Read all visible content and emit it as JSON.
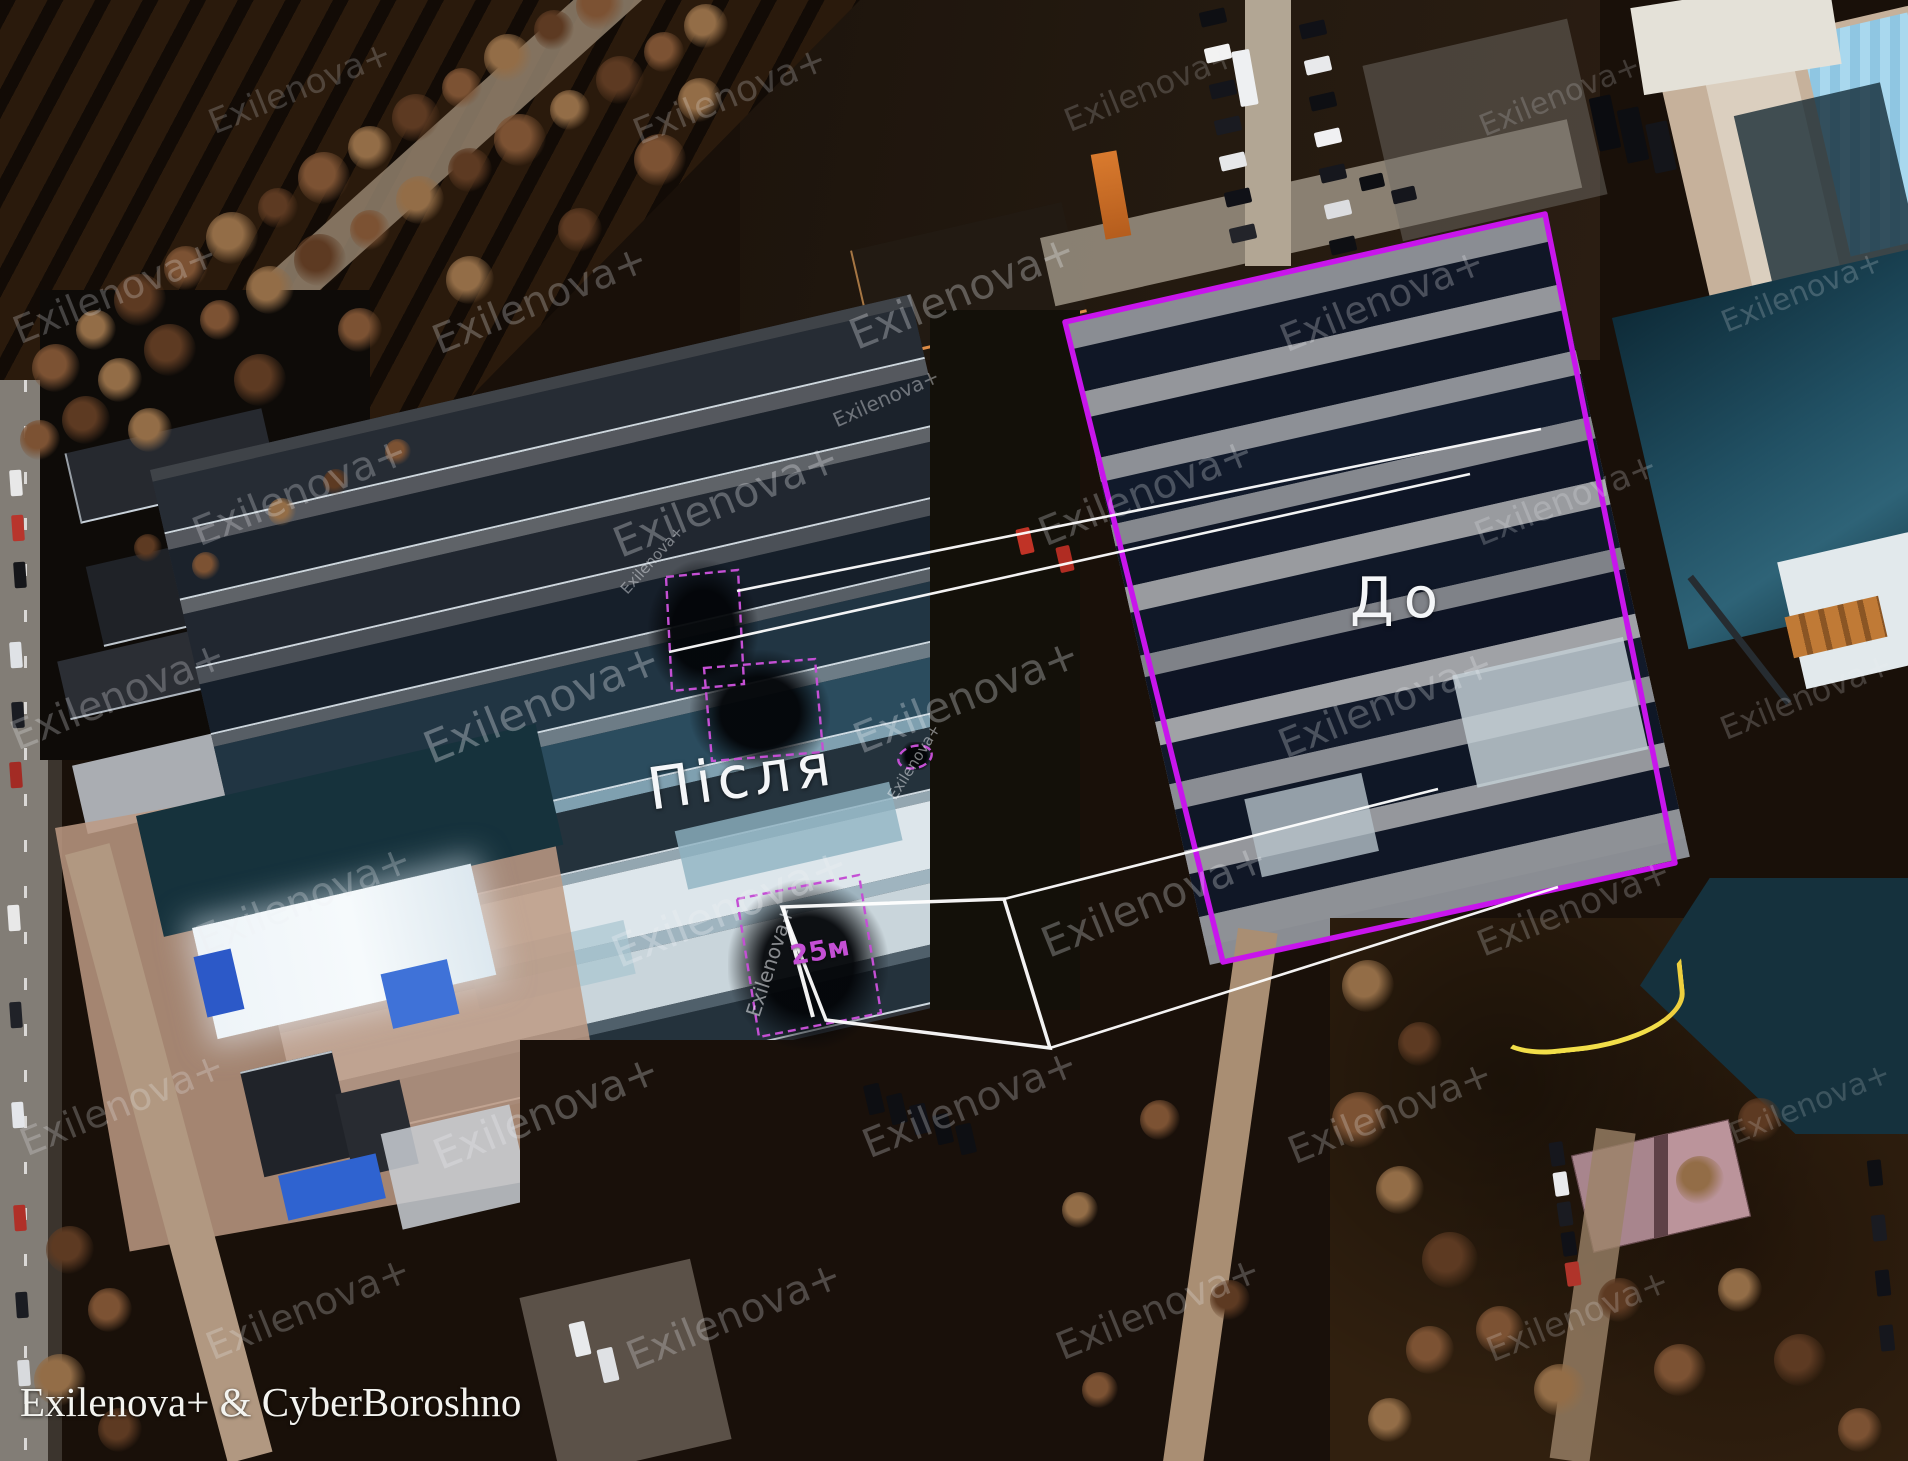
{
  "labels": {
    "before": "До",
    "after": "Після",
    "measurement": "25м"
  },
  "credit": "Exilenova+ & CyberBoroshno",
  "watermark": {
    "text": "Exilenova+",
    "instances": [
      [
        300,
        88,
        34,
        -22,
        0.2
      ],
      [
        730,
        96,
        36,
        -22,
        0.22
      ],
      [
        1150,
        88,
        32,
        -22,
        0.18
      ],
      [
        1560,
        96,
        30,
        -22,
        0.18
      ],
      [
        115,
        292,
        38,
        -22,
        0.24
      ],
      [
        540,
        300,
        40,
        -22,
        0.26
      ],
      [
        962,
        292,
        42,
        -22,
        0.3
      ],
      [
        1382,
        300,
        38,
        -22,
        0.26
      ],
      [
        1802,
        292,
        30,
        -22,
        0.2
      ],
      [
        300,
        492,
        40,
        -22,
        0.26
      ],
      [
        726,
        500,
        42,
        -22,
        0.3
      ],
      [
        1146,
        492,
        40,
        -22,
        0.26
      ],
      [
        1566,
        500,
        34,
        -22,
        0.22
      ],
      [
        118,
        696,
        40,
        -22,
        0.26
      ],
      [
        542,
        704,
        44,
        -22,
        0.32
      ],
      [
        966,
        696,
        42,
        -22,
        0.3
      ],
      [
        1386,
        704,
        40,
        -22,
        0.26
      ],
      [
        1806,
        696,
        32,
        -22,
        0.2
      ],
      [
        304,
        900,
        40,
        -22,
        0.26
      ],
      [
        730,
        908,
        44,
        -22,
        0.32
      ],
      [
        1154,
        900,
        42,
        -22,
        0.28
      ],
      [
        1574,
        908,
        36,
        -22,
        0.22
      ],
      [
        122,
        1104,
        38,
        -22,
        0.24
      ],
      [
        546,
        1112,
        42,
        -22,
        0.28
      ],
      [
        970,
        1104,
        40,
        -22,
        0.26
      ],
      [
        1390,
        1112,
        38,
        -22,
        0.24
      ],
      [
        1810,
        1104,
        30,
        -22,
        0.18
      ],
      [
        308,
        1308,
        38,
        -22,
        0.24
      ],
      [
        734,
        1316,
        40,
        -22,
        0.26
      ],
      [
        1158,
        1308,
        38,
        -22,
        0.24
      ],
      [
        1578,
        1316,
        34,
        -22,
        0.2
      ],
      [
        770,
        962,
        20,
        -72,
        0.55
      ],
      [
        914,
        762,
        15,
        -58,
        0.5
      ],
      [
        652,
        560,
        15,
        -48,
        0.45
      ],
      [
        886,
        398,
        20,
        -24,
        0.4
      ]
    ]
  },
  "colors": {
    "annotation_magenta": "#c815ec",
    "annotation_magenta_dashed": "#c44fd4",
    "annotation_white": "#ffffff",
    "label_white": "#f4f6f8"
  }
}
